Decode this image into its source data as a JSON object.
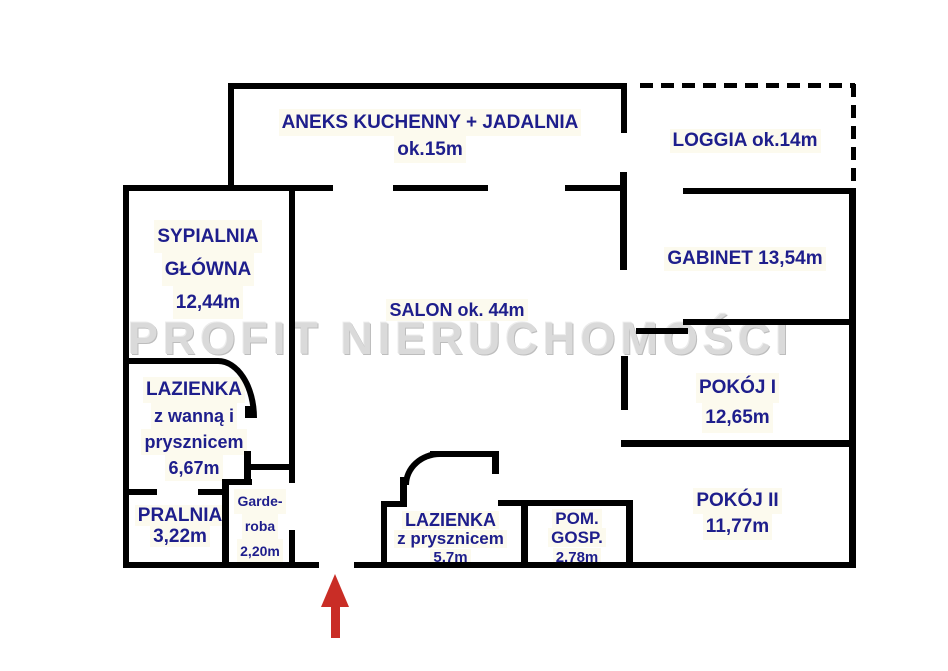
{
  "watermark": "PROFIT NIERUCHOMOŚCI",
  "colors": {
    "wall": "#000000",
    "label_text": "#1e1e8c",
    "watermark_gray": "#dadada",
    "entrance_arrow": "#c92d26"
  },
  "rooms": {
    "kitchen": {
      "lines": [
        "ANEKS KUCHENNY + JADALNIA",
        "ok.15m"
      ]
    },
    "loggia": {
      "lines": [
        "LOGGIA ok.14m"
      ]
    },
    "master_bedroom": {
      "lines": [
        "SYPIALNIA",
        "GŁÓWNA",
        "12,44m"
      ]
    },
    "salon": {
      "lines": [
        "SALON ok. 44m"
      ]
    },
    "gabinet": {
      "lines": [
        "GABINET 13,54m"
      ]
    },
    "room1": {
      "lines": [
        "POKÓJ I",
        "12,65m"
      ]
    },
    "room2": {
      "lines": [
        "POKÓJ II",
        "11,77m"
      ]
    },
    "bathroom_main": {
      "lines": [
        "LAZIENKA",
        "z wanną i",
        "prysznicem",
        "6,67m"
      ]
    },
    "laundry": {
      "lines": [
        "PRALNIA",
        "3,22m"
      ]
    },
    "wardrobe": {
      "lines": [
        "Garde-",
        "roba",
        "2,20m"
      ]
    },
    "bathroom_shower": {
      "lines": [
        "LAZIENKA",
        "z prysznicem",
        "5,7m"
      ]
    },
    "utility": {
      "lines": [
        "POM.",
        "GOSP.",
        "2,78m"
      ]
    }
  }
}
